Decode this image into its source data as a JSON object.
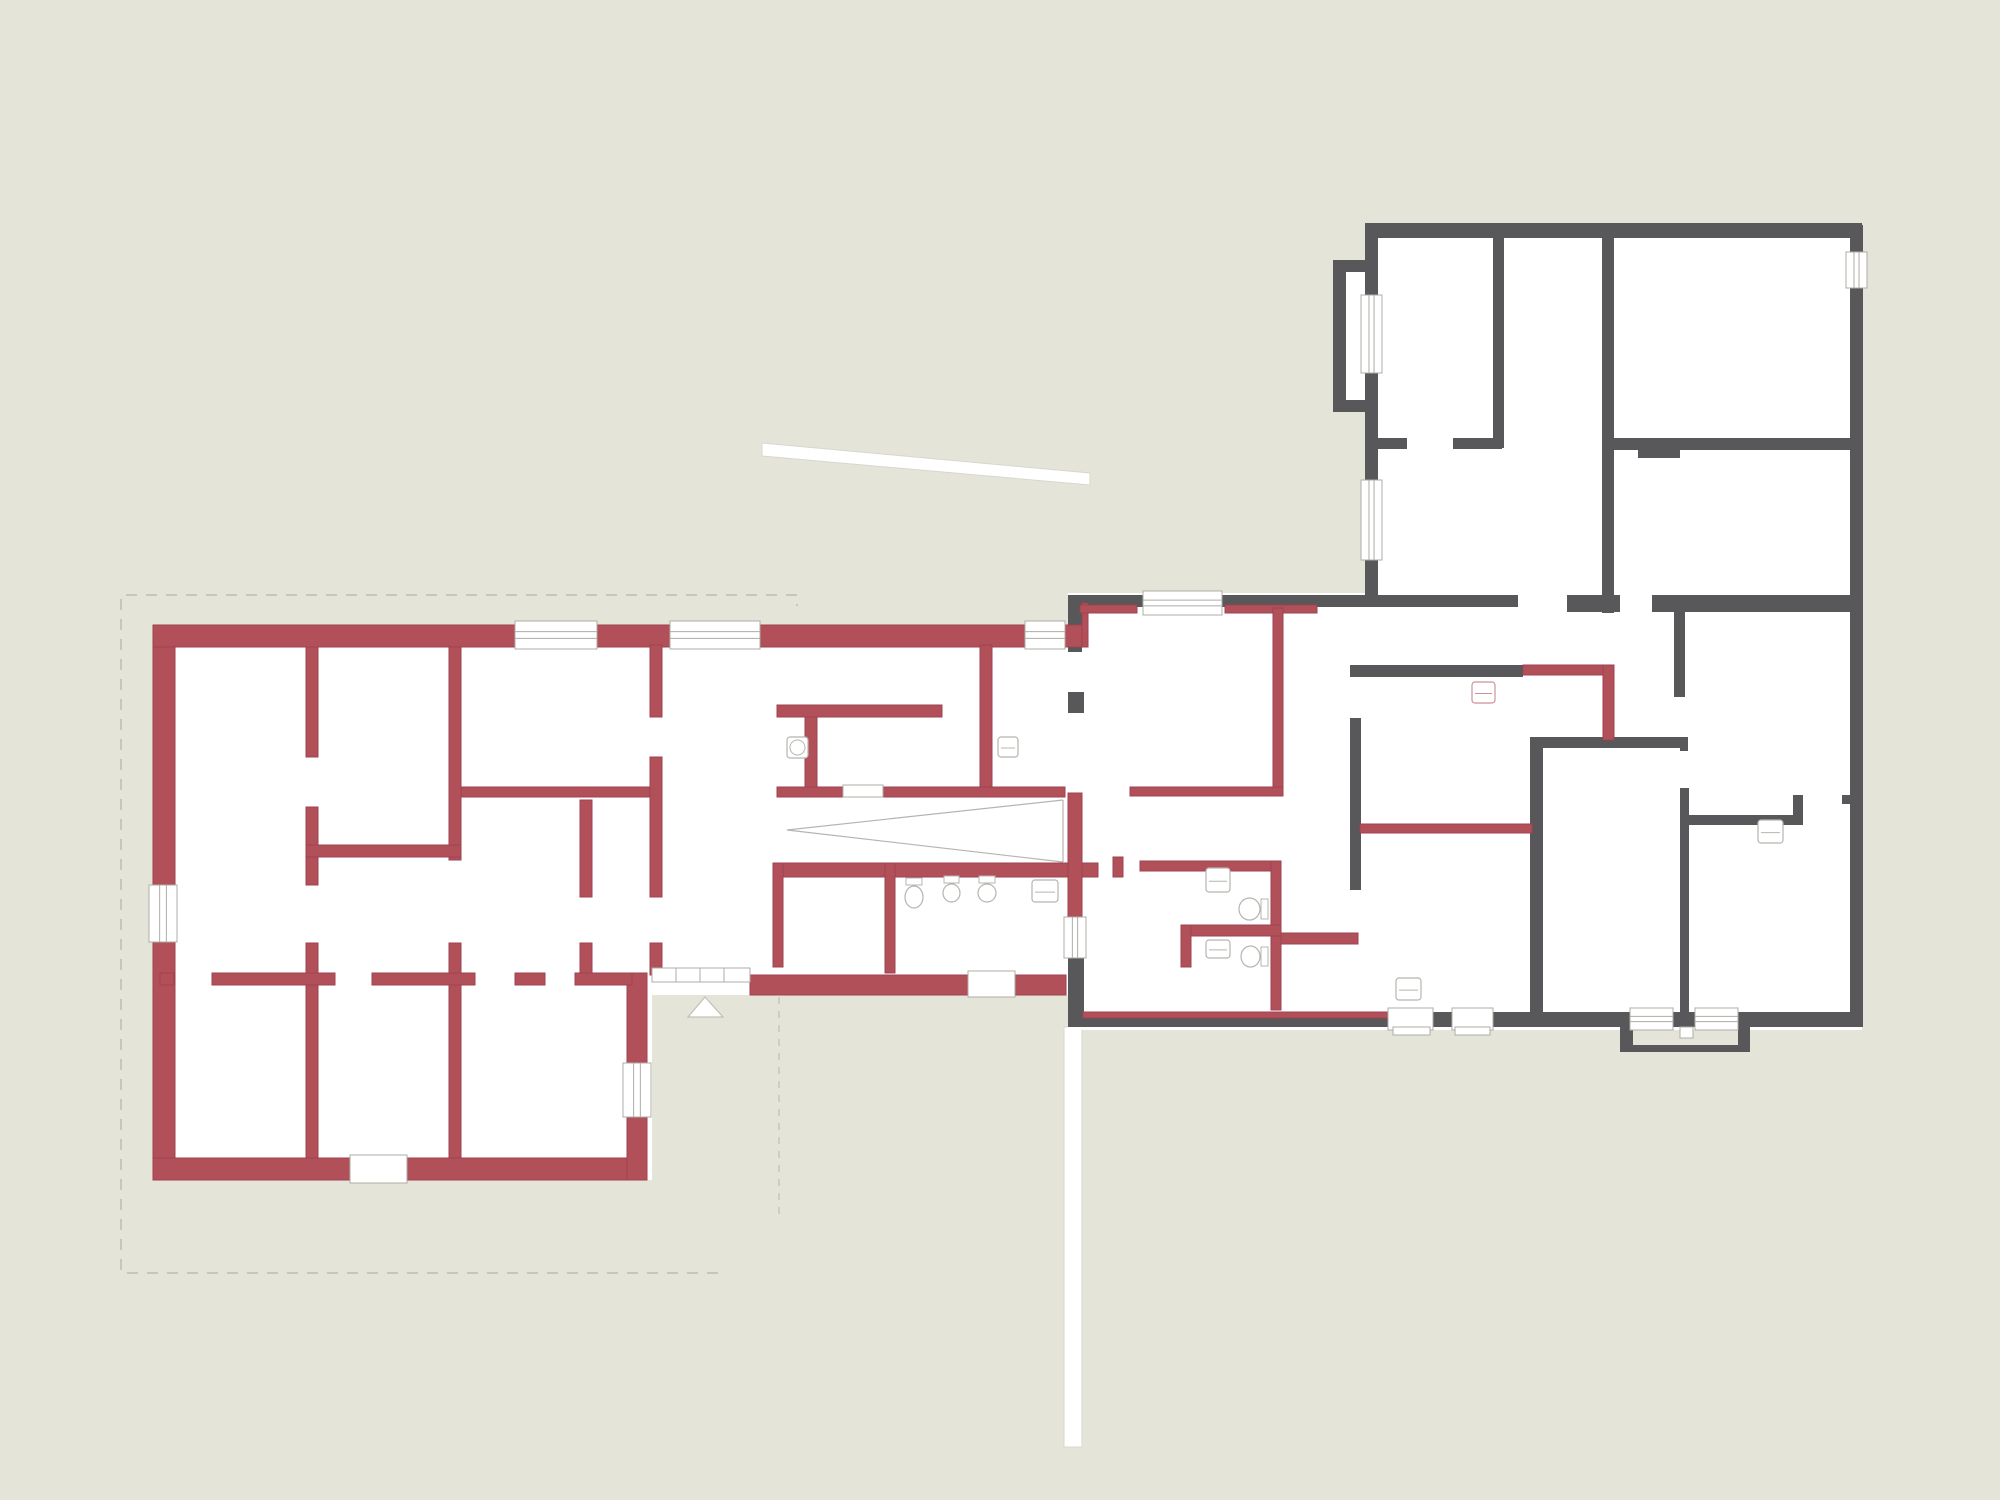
{
  "canvas": {
    "width": 2000,
    "height": 1500,
    "background": "#e5e4d8"
  },
  "colors": {
    "floor": "#ffffff",
    "red_wall": "#b2505a",
    "red_wall_edge": "#9d4250",
    "gray_wall": "#58585a",
    "thin": "#b6b4af",
    "red_thin": "#cc9298",
    "white_stroke": "#d9d7cd",
    "dash": "#c8c6ba",
    "frame": "#aeaca6",
    "tread": "#c3c1b8"
  },
  "floors": [
    [
      153,
      625,
      499,
      555
    ],
    [
      652,
      625,
      435,
      370
    ],
    [
      1068,
      593,
      794,
      437
    ],
    [
      1365,
      223,
      497,
      380
    ],
    [
      1333,
      260,
      45,
      152
    ]
  ],
  "site": {
    "boundary_dashed": [
      [
        718,
        1273
      ],
      [
        121,
        1273
      ],
      [
        121,
        595
      ],
      [
        797,
        595
      ],
      [
        797,
        606
      ]
    ],
    "faint_dashed": [
      [
        779,
        997,
        779,
        1218
      ]
    ],
    "walkway_polygon": [
      [
        762,
        443
      ],
      [
        1090,
        473
      ],
      [
        1090,
        485
      ],
      [
        762,
        456
      ]
    ],
    "bottom_path": [
      1064,
      1027,
      18,
      420
    ],
    "entrance_triangle": [
      [
        688,
        1017
      ],
      [
        723,
        1017
      ],
      [
        705,
        997
      ]
    ]
  },
  "walls_gray": [
    [
      1072,
      595,
      71,
      12
    ],
    [
      1222,
      595,
      296,
      12
    ],
    [
      1567,
      595,
      53,
      17
    ],
    [
      1652,
      595,
      211,
      17
    ],
    [
      1068,
      595,
      14,
      57
    ],
    [
      1068,
      692,
      16,
      21
    ],
    [
      1068,
      958,
      16,
      69
    ],
    [
      1068,
      1012,
      320,
      15
    ],
    [
      1433,
      1012,
      19,
      15
    ],
    [
      1493,
      1012,
      137,
      15
    ],
    [
      1673,
      1012,
      22,
      15
    ],
    [
      1738,
      1012,
      124,
      15
    ],
    [
      1850,
      225,
      13,
      27
    ],
    [
      1850,
      288,
      13,
      739
    ],
    [
      1365,
      223,
      497,
      15
    ],
    [
      1365,
      238,
      13,
      57
    ],
    [
      1365,
      373,
      13,
      107
    ],
    [
      1365,
      560,
      13,
      43
    ],
    [
      1333,
      260,
      45,
      12
    ],
    [
      1333,
      272,
      13,
      128
    ],
    [
      1333,
      400,
      45,
      12
    ],
    [
      1493,
      238,
      11,
      210
    ],
    [
      1377,
      438,
      30,
      11
    ],
    [
      1453,
      438,
      49,
      11
    ],
    [
      1602,
      238,
      12,
      375
    ],
    [
      1602,
      438,
      248,
      12
    ],
    [
      1638,
      450,
      42,
      8
    ],
    [
      1674,
      612,
      11,
      85
    ],
    [
      1530,
      737,
      150,
      11
    ],
    [
      1680,
      737,
      8,
      14
    ],
    [
      1530,
      743,
      13,
      270
    ],
    [
      1680,
      788,
      9,
      239
    ],
    [
      1688,
      815,
      109,
      10
    ],
    [
      1793,
      795,
      10,
      30
    ],
    [
      1842,
      795,
      10,
      9
    ],
    [
      1350,
      665,
      173,
      12
    ],
    [
      1350,
      718,
      11,
      172
    ],
    [
      1620,
      1027,
      13,
      25
    ],
    [
      1620,
      1045,
      130,
      7
    ],
    [
      1738,
      1027,
      12,
      25
    ]
  ],
  "walls_red": [
    [
      153,
      625,
      362,
      22
    ],
    [
      597,
      625,
      73,
      22
    ],
    [
      760,
      625,
      265,
      22
    ],
    [
      1065,
      625,
      17,
      22
    ],
    [
      1082,
      603,
      6,
      44
    ],
    [
      153,
      647,
      22,
      238
    ],
    [
      153,
      942,
      22,
      238
    ],
    [
      153,
      1158,
      197,
      22
    ],
    [
      407,
      1158,
      240,
      22
    ],
    [
      627,
      973,
      20,
      90
    ],
    [
      627,
      1117,
      20,
      63
    ],
    [
      750,
      975,
      218,
      20
    ],
    [
      1015,
      975,
      51,
      20
    ],
    [
      780,
      863,
      318,
      14
    ],
    [
      773,
      863,
      10,
      104
    ],
    [
      885,
      863,
      10,
      110
    ],
    [
      1068,
      793,
      14,
      124
    ],
    [
      1113,
      857,
      10,
      20
    ],
    [
      306,
      647,
      12,
      110
    ],
    [
      306,
      807,
      12,
      78
    ],
    [
      306,
      943,
      12,
      215
    ],
    [
      449,
      647,
      12,
      213
    ],
    [
      449,
      943,
      12,
      215
    ],
    [
      580,
      800,
      12,
      97
    ],
    [
      580,
      943,
      12,
      40
    ],
    [
      306,
      845,
      155,
      12
    ],
    [
      160,
      973,
      14,
      12
    ],
    [
      212,
      973,
      123,
      12
    ],
    [
      372,
      973,
      103,
      12
    ],
    [
      515,
      973,
      30,
      12
    ],
    [
      575,
      973,
      57,
      12
    ],
    [
      461,
      787,
      197,
      10
    ],
    [
      777,
      787,
      66,
      10
    ],
    [
      883,
      787,
      182,
      10
    ],
    [
      650,
      645,
      12,
      72
    ],
    [
      650,
      757,
      12,
      140
    ],
    [
      650,
      943,
      12,
      32
    ],
    [
      777,
      705,
      165,
      12
    ],
    [
      805,
      717,
      12,
      70
    ],
    [
      980,
      645,
      12,
      142
    ],
    [
      1080,
      605,
      57,
      8
    ],
    [
      1225,
      605,
      92,
      8
    ],
    [
      1273,
      608,
      10,
      187
    ],
    [
      1130,
      787,
      153,
      9
    ],
    [
      1140,
      861,
      141,
      10
    ],
    [
      1271,
      861,
      10,
      149
    ],
    [
      1181,
      925,
      100,
      11
    ],
    [
      1181,
      925,
      10,
      42
    ],
    [
      1281,
      933,
      77,
      11
    ],
    [
      1360,
      824,
      172,
      9
    ],
    [
      1523,
      665,
      91,
      10
    ],
    [
      1603,
      665,
      11,
      75
    ],
    [
      1083,
      1012,
      305,
      6
    ]
  ],
  "openings": [
    {
      "r": [
        515,
        621,
        82,
        28
      ],
      "o": "h",
      "t": "win"
    },
    {
      "r": [
        670,
        621,
        90,
        28
      ],
      "o": "h",
      "t": "win"
    },
    {
      "r": [
        1025,
        621,
        40,
        28
      ],
      "o": "h",
      "t": "win"
    },
    {
      "r": [
        149,
        885,
        28,
        57
      ],
      "o": "v",
      "t": "win"
    },
    {
      "r": [
        623,
        1063,
        28,
        54
      ],
      "o": "v",
      "t": "win"
    },
    {
      "r": [
        1064,
        917,
        22,
        41
      ],
      "o": "v",
      "t": "win"
    },
    {
      "r": [
        1143,
        591,
        79,
        24
      ],
      "o": "h",
      "t": "win"
    },
    {
      "r": [
        1361,
        295,
        21,
        78
      ],
      "o": "v",
      "t": "win"
    },
    {
      "r": [
        1361,
        480,
        21,
        80
      ],
      "o": "v",
      "t": "win"
    },
    {
      "r": [
        1846,
        252,
        21,
        36
      ],
      "o": "v",
      "t": "win"
    },
    {
      "r": [
        1630,
        1008,
        43,
        22
      ],
      "o": "h",
      "t": "win"
    },
    {
      "r": [
        1695,
        1008,
        43,
        22
      ],
      "o": "h",
      "t": "win"
    },
    {
      "r": [
        1388,
        1008,
        45,
        22
      ],
      "o": "h",
      "t": "door"
    },
    {
      "r": [
        1452,
        1008,
        41,
        22
      ],
      "o": "h",
      "t": "door"
    },
    {
      "r": [
        350,
        1155,
        57,
        28
      ],
      "o": "h",
      "t": "door"
    },
    {
      "r": [
        968,
        971,
        47,
        26
      ],
      "o": "h",
      "t": "door"
    },
    {
      "r": [
        652,
        968,
        98,
        14
      ],
      "o": "h",
      "t": "thresh"
    },
    {
      "r": [
        843,
        785,
        40,
        12
      ],
      "o": "h",
      "t": "thresh"
    }
  ],
  "steps": [
    [
      1393,
      1027,
      37,
      8
    ],
    [
      1455,
      1027,
      35,
      8
    ],
    [
      1680,
      1027,
      13,
      11
    ]
  ],
  "fixtures": {
    "sinks": [
      {
        "r": [
          787,
          737,
          21,
          21
        ],
        "circle": true
      },
      {
        "r": [
          998,
          737,
          20,
          20
        ]
      },
      {
        "r": [
          1206,
          868,
          24,
          24
        ]
      },
      {
        "r": [
          1206,
          940,
          24,
          18
        ]
      },
      {
        "r": [
          1032,
          880,
          26,
          22
        ]
      },
      {
        "r": [
          1396,
          978,
          25,
          22
        ]
      },
      {
        "r": [
          1758,
          820,
          25,
          23
        ]
      },
      {
        "r": [
          1472,
          682,
          23,
          21
        ],
        "red": true
      }
    ],
    "toilets": [
      {
        "r": [
          905,
          880,
          18,
          26
        ],
        "side": "top"
      },
      {
        "r": [
          943,
          878,
          17,
          22
        ],
        "side": "top"
      },
      {
        "r": [
          978,
          878,
          18,
          22
        ],
        "side": "top"
      },
      {
        "r": [
          1241,
          898,
          25,
          22
        ],
        "side": "right"
      },
      {
        "r": [
          1243,
          946,
          23,
          21
        ],
        "side": "right"
      }
    ],
    "dividers": [
      [
        935,
        877,
        2,
        93
      ],
      [
        966,
        877,
        3,
        24
      ],
      [
        1003,
        877,
        3,
        24
      ]
    ],
    "showers": [
      {
        "r": [
          795,
          892,
          79,
          57
        ],
        "inner": true
      },
      {
        "r": [
          1283,
          947,
          43,
          55
        ],
        "round": true,
        "lines": [
          [
            1330,
            947,
            1330,
            1002
          ],
          [
            1344,
            947,
            1344,
            1002
          ]
        ]
      }
    ],
    "shelf": {
      "r": [
        1505,
        897,
        25,
        115
      ],
      "rungs": 7
    },
    "wardrobe": {
      "r": [
        1662,
        507,
        190,
        91
      ],
      "dividers": [
        1725,
        1790
      ]
    },
    "kitchen_unit": {
      "r": [
        1565,
        683,
        38,
        54
      ]
    },
    "counter": {
      "r": [
        1285,
        1002,
        152,
        10
      ]
    },
    "chimney": {
      "r": [
        1833,
        196,
        29,
        29
      ]
    },
    "right_wall_ticks": {
      "white": [
        1863,
        253,
        25,
        34
      ],
      "lines": [
        [
          1863,
          252,
          1888,
          252
        ],
        [
          1863,
          288,
          1888,
          288
        ]
      ]
    }
  },
  "stairs": [
    {
      "name": "corridor-stair",
      "box": [
        777,
        647,
        63,
        58
      ],
      "treads": 6,
      "diag": [
        777,
        705,
        840,
        647
      ],
      "outlined": false
    },
    {
      "name": "main-stair",
      "box": [
        1360,
        798,
        172,
        60
      ],
      "treads": 12,
      "outlined": false
    },
    {
      "name": "exterior-stair-top",
      "bg": [
        1088,
        468,
        108,
        86
      ],
      "box": [
        1098,
        486,
        94,
        64
      ],
      "treads": 7,
      "outlined": true
    },
    {
      "name": "exterior-stair-bottom",
      "bg": [
        1028,
        1098,
        84,
        88
      ],
      "box": [
        1036,
        1106,
        68,
        72
      ],
      "treads": 5,
      "outlined": true
    }
  ],
  "chevrons": [
    [
      812,
      666,
      822,
      675,
      812,
      684
    ],
    [
      1158,
      505,
      1172,
      519,
      1158,
      533
    ],
    [
      1082,
      1130,
      1095,
      1143,
      1082,
      1156
    ]
  ],
  "ramp_lines": [
    [
      787,
      830,
      1063,
      800
    ],
    [
      787,
      830,
      1063,
      862
    ],
    [
      1063,
      800,
      1063,
      862
    ]
  ],
  "winder": {
    "lines": [
      [
        1795,
        697,
        1685,
        618
      ],
      [
        1795,
        697,
        1730,
        615
      ],
      [
        1795,
        697,
        1772,
        613
      ],
      [
        1795,
        697,
        1812,
        615
      ],
      [
        1795,
        697,
        1845,
        622
      ],
      [
        1815,
        697,
        1815,
        790
      ],
      [
        1833,
        700,
        1833,
        790
      ],
      [
        1795,
        697,
        1795,
        770
      ]
    ],
    "dash_path": [
      [
        1690,
        686
      ],
      [
        1788,
        686
      ],
      [
        1788,
        768
      ]
    ],
    "dash_rect": [
      1742,
      672,
      52,
      22
    ]
  },
  "threshold_ticks": [
    [
      676,
      968,
      676,
      982
    ],
    [
      700,
      968,
      700,
      982
    ],
    [
      724,
      968,
      724,
      982
    ]
  ]
}
